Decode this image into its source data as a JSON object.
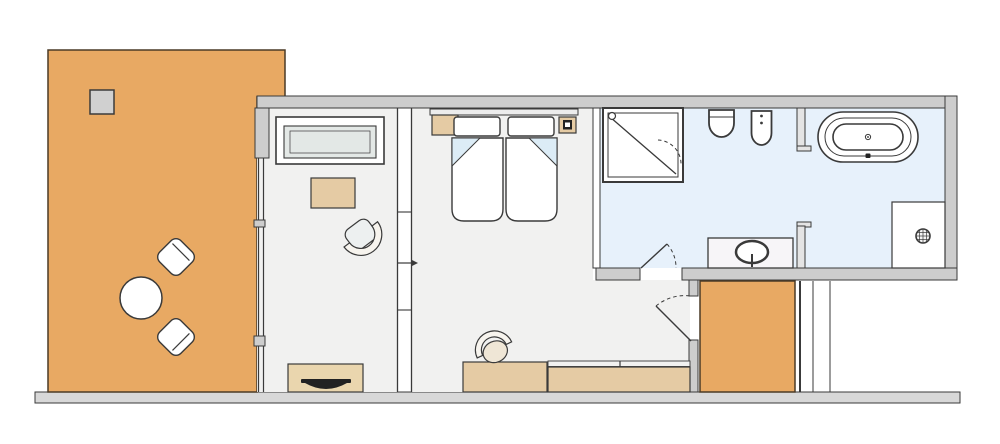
{
  "palette": {
    "outline": "#3a3a3a",
    "outline_warm": "#4a3a26",
    "wall_fill": "#cdcdcd",
    "wall_light": "#e4e4e4",
    "floor_indoor": "#f1f1f0",
    "floor_bath": "#e7f1fb",
    "floor_terrace": "#e8a963",
    "furn_beige": "#e5cba4",
    "furn_beige_light": "#ead6ae",
    "seat_gray": "#e3e8e6",
    "fold_blue": "#dcecf6",
    "dark": "#222222",
    "white": "#ffffff",
    "baseline_fill": "#d8d8d8",
    "terrace_square": "#d0d0d0",
    "vanity_fill": "#f7f5f8",
    "headboard_fill": "#ececec",
    "chair_seat": "#efe6d6",
    "chair_band": "#f7f4ee"
  },
  "inventory": {
    "rooms": [
      "terrace",
      "living-area",
      "bedroom",
      "bathroom-wc",
      "bathroom-tub",
      "entry"
    ],
    "icons": [
      "terrace-table-icon",
      "terrace-chair-icon",
      "sofa-icon",
      "coffee-table-icon",
      "armchair-icon",
      "tv-console-icon",
      "twin-bed-icon",
      "pillow-icon",
      "nightstand-icon",
      "phone-panel-icon",
      "bench-sofa-icon",
      "tub-chair-icon",
      "shower-stall-icon",
      "toilet-icon",
      "bidet-icon",
      "vanity-sink-icon",
      "bathtub-icon",
      "walk-in-shower-drain-icon",
      "door-swing-icon",
      "slide-arrow-icon"
    ]
  }
}
